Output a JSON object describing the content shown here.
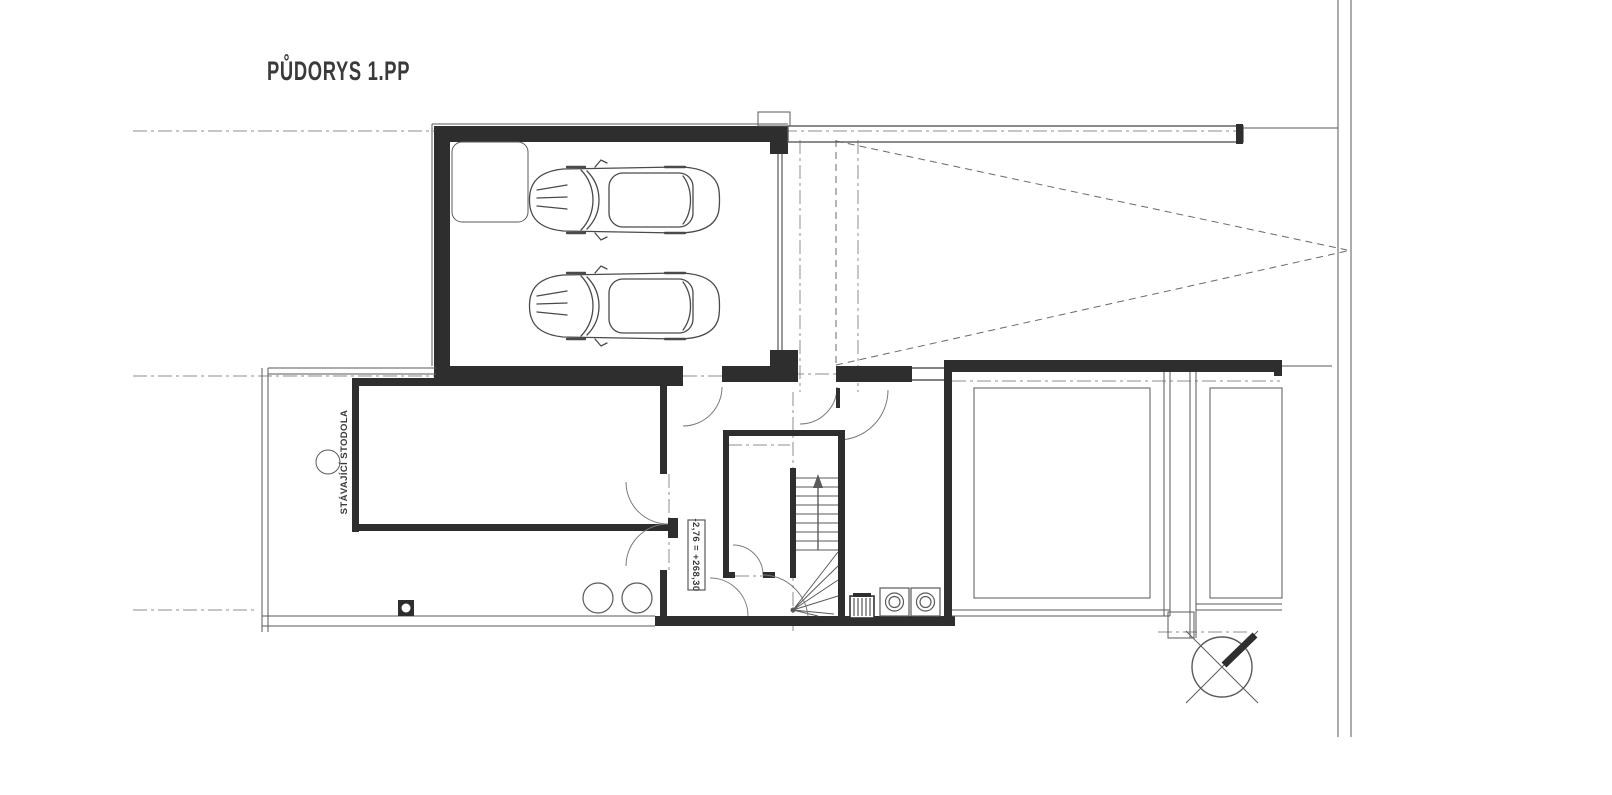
{
  "plan": {
    "title": "PŮDORYS 1.PP",
    "room_label": "STÁVAJÍCÍ STODOLA",
    "elevation_label": "-2,76 = +268,30",
    "colors": {
      "wall": "#2e2e2e",
      "line": "#5a5a5a",
      "arc": "#7a7a7a",
      "axis": "#8c8c8c",
      "door_panel": "#9a9a9a",
      "background": "#ffffff",
      "text": "#3a3a3a"
    },
    "symbols": {
      "north_arrow": "north-arrow-icon",
      "car": "car-top-view-icon",
      "washing_machine": "washing-machine-icon",
      "boiler": "boiler-icon",
      "stair_direction_arrow": "up-arrow-icon",
      "column": "round-column-symbol",
      "tanks": "round-tank-symbol",
      "floor_drain": "floor-drain-symbol"
    }
  }
}
